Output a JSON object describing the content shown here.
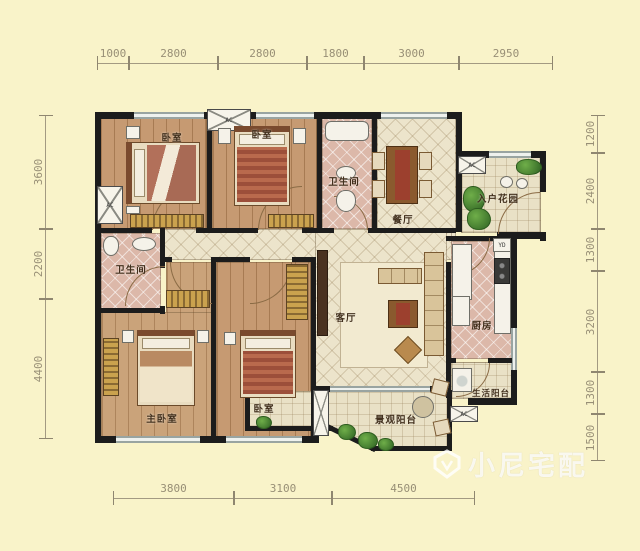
{
  "watermark": {
    "brand": "小尼宅配"
  },
  "equipment": {
    "ac": "AC",
    "yd": "YD"
  },
  "rooms": {
    "bedroom1": {
      "label": "卧室"
    },
    "bedroom2": {
      "label": "卧室"
    },
    "bath1": {
      "label": "卫生间"
    },
    "dining": {
      "label": "餐厅"
    },
    "entry_garden": {
      "label": "入户花园"
    },
    "bath2": {
      "label": "卫生间"
    },
    "living": {
      "label": "客厅"
    },
    "kitchen": {
      "label": "厨房"
    },
    "utility_balcony": {
      "label": "生活阳台"
    },
    "master_bedroom": {
      "label": "主卧室"
    },
    "bedroom3": {
      "label": "卧室"
    },
    "view_balcony": {
      "label": "景观阳台"
    }
  },
  "dims": {
    "top": [
      "1000",
      "2800",
      "2800",
      "1800",
      "3000",
      "2950"
    ],
    "left": [
      "3600",
      "2200",
      "4400"
    ],
    "right": [
      "1200",
      "2400",
      "1300",
      "3200",
      "1300",
      "1500"
    ],
    "bottom": [
      "3800",
      "3100",
      "4500"
    ]
  },
  "colors": {
    "background": "#f9f3c9",
    "wall": "#1c1c1c",
    "wood_floor": "#c29469",
    "tile_floor": "#ece4cb",
    "wet_floor": "#dcb8a9",
    "plant_green": "#4f8f3a"
  }
}
